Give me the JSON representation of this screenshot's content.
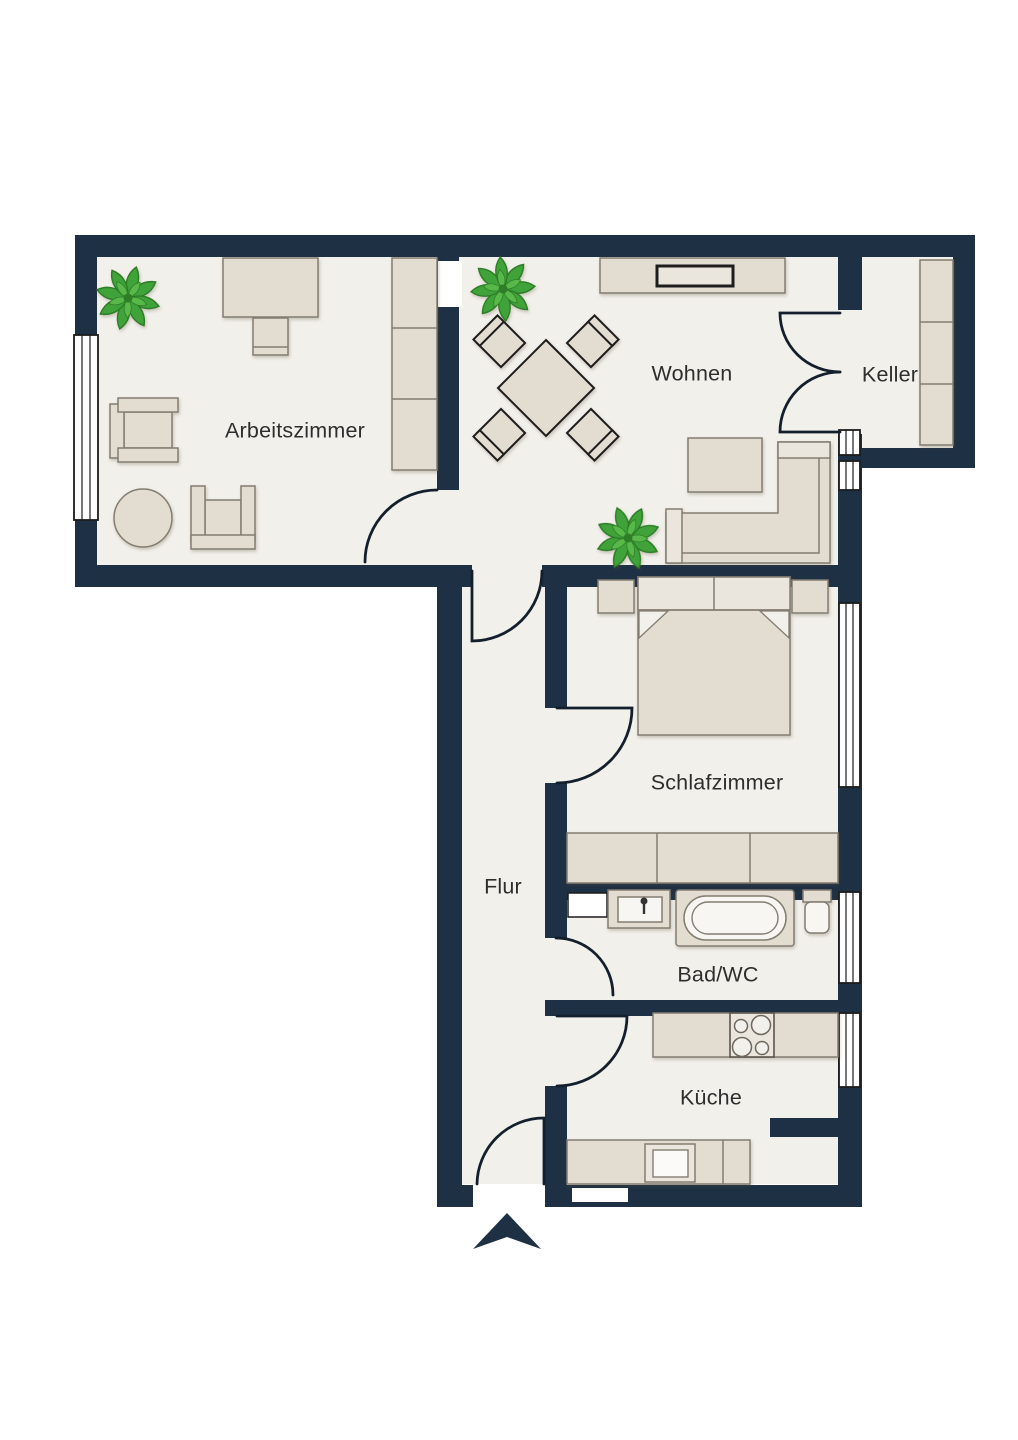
{
  "rooms": {
    "arbeitszimmer": {
      "label": "Arbeitszimmer"
    },
    "wohnen": {
      "label": "Wohnen"
    },
    "keller": {
      "label": "Keller"
    },
    "schlafzimmer": {
      "label": "Schlafzimmer"
    },
    "flur": {
      "label": "Flur"
    },
    "bad_wc": {
      "label": "Bad/WC"
    },
    "kueche": {
      "label": "Küche"
    }
  },
  "colors": {
    "background": "#ffffff",
    "wall": "#1e3044",
    "floor": "#f2f0ea",
    "furniture": "#e3dcd1",
    "furniture_light": "#ebe6dd",
    "furniture_stroke": "#837d71",
    "dark_outline": "#1d1d1d",
    "door_arc": "#141f2d",
    "plant_green": "#3fa33a",
    "plant_dark": "#2e7d27",
    "label_text": "#2e2e2e"
  },
  "icons": [
    "plant-icon",
    "desk",
    "desk-chair",
    "wardrobe",
    "armchair",
    "side-table",
    "dining-table",
    "dining-chair",
    "tv-sideboard",
    "tv",
    "coffee-table",
    "corner-sofa",
    "shelf",
    "double-bed",
    "nightstand",
    "sink",
    "bathtub",
    "toilet",
    "kitchen-counter",
    "stove",
    "kitchen-sink",
    "window",
    "door-arc",
    "entrance-arrow"
  ]
}
